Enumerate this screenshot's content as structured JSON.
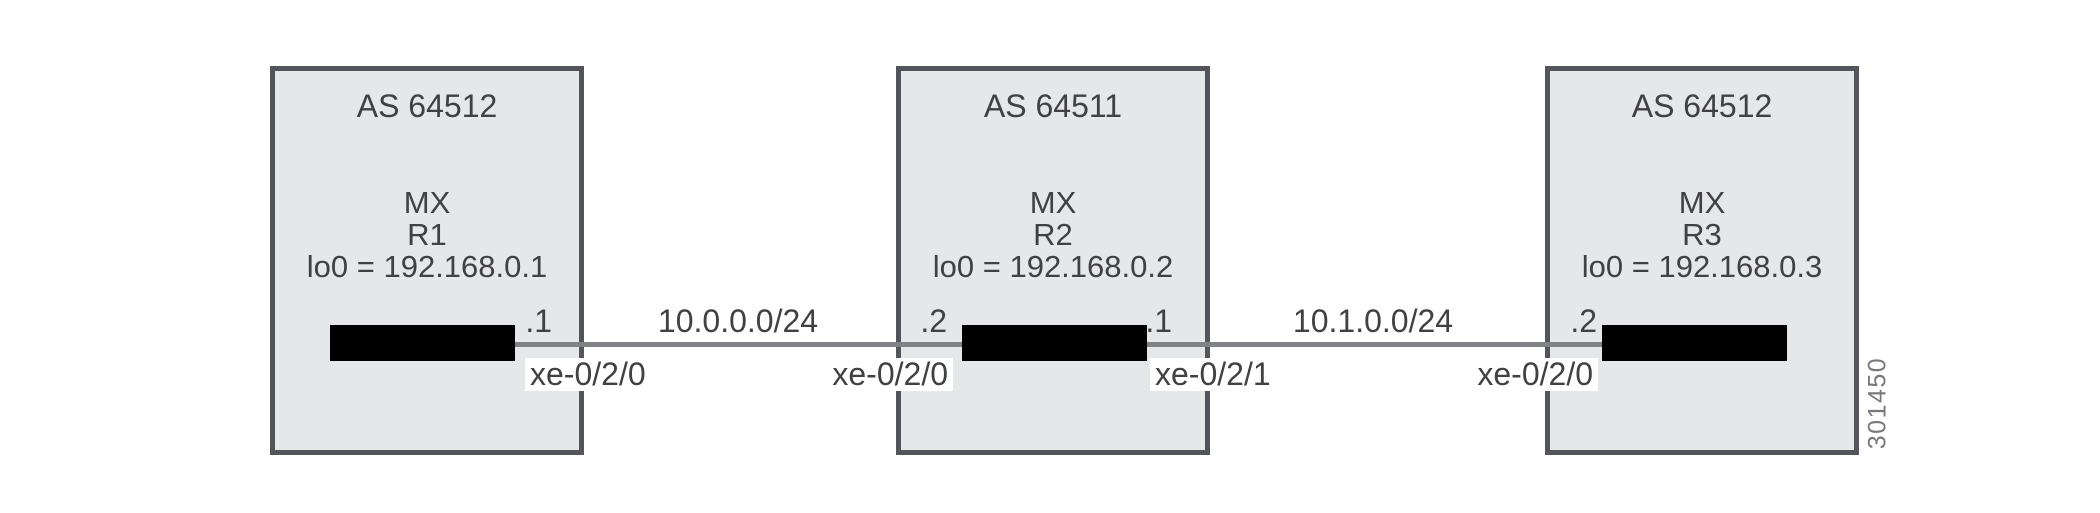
{
  "figure_number": "301450",
  "colors": {
    "box_fill": "#e6e7e8",
    "box_border": "#54555a",
    "link_line": "#808285",
    "router_green": "#8cba43",
    "text": "#414042",
    "figure_number_text": "#77787b"
  },
  "routers": [
    {
      "as_label": "AS 64512",
      "platform": "MX",
      "name": "R1",
      "loopback": "lo0 = 192.168.0.1"
    },
    {
      "as_label": "AS 64511",
      "platform": "MX",
      "name": "R2",
      "loopback": "lo0 = 192.168.0.2"
    },
    {
      "as_label": "AS 64512",
      "platform": "MX",
      "name": "R3",
      "loopback": "lo0 = 192.168.0.3"
    }
  ],
  "links": [
    {
      "subnet": "10.0.0.0/24",
      "left": {
        "router": "R1",
        "ip": ".1",
        "interface": "xe-0/2/0"
      },
      "right": {
        "router": "R2",
        "ip": ".2",
        "interface": "xe-0/2/0"
      }
    },
    {
      "subnet": "10.1.0.0/24",
      "left": {
        "router": "R2",
        "ip": ".1",
        "interface": "xe-0/2/1"
      },
      "right": {
        "router": "R3",
        "ip": ".2",
        "interface": "xe-0/2/0"
      }
    }
  ]
}
